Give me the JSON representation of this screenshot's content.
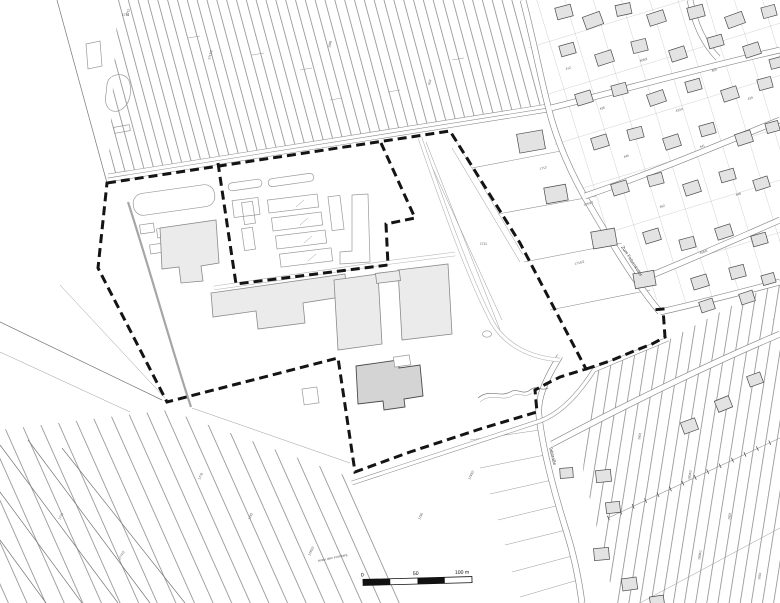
{
  "map": {
    "type": "cadastral-site-plan",
    "colors": {
      "boundary": "#141414",
      "building_fill": "#ebebeb",
      "building_dark": "#d4d4d4",
      "parcel_line": "#777",
      "background": "#ffffff"
    },
    "scale_bar": {
      "label_0": "0",
      "label_50": "50",
      "label_100": "100 m"
    },
    "labels": [
      [
        621,
        247,
        57,
        4.6,
        "Zum Felsenkeller",
        "slbl"
      ],
      [
        549,
        447,
        76,
        4.6,
        "Talstraße",
        "slbl"
      ],
      [
        318,
        562,
        -12,
        3.2,
        "Hinter dem Kirchberg",
        "lbl"
      ],
      [
        128,
        16,
        -75,
        3.2,
        "1712",
        "lbl"
      ],
      [
        210,
        60,
        -75,
        3.2,
        "1713/2",
        "lbl"
      ],
      [
        330,
        48,
        -75,
        3.2,
        "1699",
        "lbl"
      ],
      [
        430,
        85,
        -75,
        3.2,
        "853",
        "lbl"
      ],
      [
        566,
        70,
        -17,
        3.2,
        "412",
        "lbl"
      ],
      [
        640,
        62,
        -17,
        3.2,
        "408/2",
        "lbl"
      ],
      [
        712,
        72,
        -17,
        3.2,
        "405",
        "lbl"
      ],
      [
        600,
        110,
        -17,
        3.2,
        "436",
        "lbl"
      ],
      [
        676,
        112,
        -17,
        3.2,
        "433/1",
        "lbl"
      ],
      [
        748,
        100,
        -17,
        3.2,
        "429",
        "lbl"
      ],
      [
        624,
        158,
        -17,
        3.2,
        "446",
        "lbl"
      ],
      [
        700,
        148,
        -17,
        3.2,
        "441",
        "lbl"
      ],
      [
        584,
        206,
        -17,
        3.2,
        "1650/2",
        "lbl"
      ],
      [
        660,
        208,
        -17,
        3.2,
        "452",
        "lbl"
      ],
      [
        736,
        196,
        -17,
        3.2,
        "448",
        "lbl"
      ],
      [
        700,
        254,
        -17,
        3.2,
        "458/3",
        "lbl"
      ],
      [
        480,
        245,
        0,
        3.2,
        "1711",
        "lbl"
      ],
      [
        540,
        170,
        -15,
        3.2,
        "1713",
        "lbl"
      ],
      [
        575,
        265,
        -15,
        3.2,
        "1715/2",
        "lbl"
      ],
      [
        250,
        520,
        -65,
        3.2,
        "1782",
        "lbl"
      ],
      [
        310,
        556,
        -65,
        3.2,
        "1785/3",
        "lbl"
      ],
      [
        200,
        480,
        -65,
        3.2,
        "1778",
        "lbl"
      ],
      [
        420,
        520,
        -65,
        3.2,
        "1790",
        "lbl"
      ],
      [
        470,
        480,
        -65,
        3.2,
        "1793/2",
        "lbl"
      ],
      [
        640,
        440,
        -80,
        3.2,
        "1801",
        "lbl"
      ],
      [
        690,
        480,
        -80,
        3.2,
        "1804/2",
        "lbl"
      ],
      [
        730,
        520,
        -80,
        3.2,
        "1807",
        "lbl"
      ],
      [
        760,
        580,
        -80,
        3.2,
        "1810",
        "lbl"
      ],
      [
        700,
        560,
        -80,
        3.2,
        "1806/1",
        "lbl"
      ],
      [
        60,
        520,
        -60,
        3.2,
        "1775",
        "lbl"
      ],
      [
        120,
        560,
        -60,
        3.2,
        "1772/2",
        "lbl"
      ],
      [
        122,
        16,
        0,
        3.2,
        "1718",
        "lbl"
      ]
    ],
    "houses": [
      [
        556,
        6,
        16,
        12,
        -15
      ],
      [
        584,
        14,
        18,
        13,
        -20
      ],
      [
        616,
        4,
        15,
        11,
        -12
      ],
      [
        648,
        12,
        17,
        12,
        -18
      ],
      [
        688,
        6,
        16,
        12,
        -15
      ],
      [
        726,
        14,
        18,
        12,
        -20
      ],
      [
        762,
        6,
        14,
        11,
        -15
      ],
      [
        560,
        44,
        15,
        11,
        -16
      ],
      [
        596,
        52,
        17,
        12,
        -18
      ],
      [
        632,
        40,
        15,
        12,
        -14
      ],
      [
        670,
        48,
        16,
        12,
        -18
      ],
      [
        708,
        36,
        15,
        11,
        -16
      ],
      [
        744,
        44,
        16,
        12,
        -18
      ],
      [
        770,
        58,
        12,
        10,
        -15
      ],
      [
        576,
        92,
        16,
        12,
        -17
      ],
      [
        612,
        84,
        15,
        11,
        -15
      ],
      [
        648,
        92,
        17,
        12,
        -19
      ],
      [
        686,
        80,
        15,
        11,
        -16
      ],
      [
        722,
        88,
        16,
        12,
        -18
      ],
      [
        758,
        78,
        14,
        11,
        -15
      ],
      [
        592,
        136,
        16,
        12,
        -17
      ],
      [
        628,
        128,
        15,
        11,
        -15
      ],
      [
        664,
        136,
        16,
        12,
        -18
      ],
      [
        700,
        124,
        15,
        11,
        -16
      ],
      [
        736,
        132,
        16,
        12,
        -18
      ],
      [
        766,
        122,
        13,
        10,
        -15
      ],
      [
        612,
        182,
        16,
        12,
        -17
      ],
      [
        648,
        174,
        15,
        11,
        -15
      ],
      [
        684,
        182,
        16,
        12,
        -18
      ],
      [
        720,
        170,
        15,
        11,
        -16
      ],
      [
        754,
        178,
        15,
        11,
        -18
      ],
      [
        644,
        230,
        16,
        12,
        -17
      ],
      [
        680,
        238,
        15,
        11,
        -15
      ],
      [
        716,
        226,
        16,
        12,
        -18
      ],
      [
        752,
        234,
        15,
        11,
        -16
      ],
      [
        692,
        276,
        16,
        12,
        -17
      ],
      [
        730,
        266,
        15,
        12,
        -15
      ],
      [
        762,
        274,
        13,
        10,
        -16
      ],
      [
        518,
        132,
        26,
        19,
        -10
      ],
      [
        545,
        186,
        22,
        16,
        -10
      ],
      [
        592,
        230,
        24,
        17,
        -10
      ],
      [
        634,
        272,
        21,
        15,
        -10
      ],
      [
        560,
        468,
        13,
        10,
        -4
      ],
      [
        596,
        470,
        15,
        12,
        -6
      ],
      [
        606,
        502,
        14,
        11,
        -6
      ],
      [
        594,
        548,
        15,
        12,
        -5
      ],
      [
        622,
        578,
        15,
        12,
        -8
      ],
      [
        650,
        596,
        14,
        10,
        -8
      ],
      [
        682,
        420,
        15,
        12,
        -20
      ],
      [
        716,
        398,
        15,
        12,
        -22
      ],
      [
        748,
        374,
        14,
        11,
        -20
      ],
      [
        700,
        300,
        14,
        11,
        -18
      ],
      [
        740,
        292,
        14,
        11,
        -18
      ]
    ]
  }
}
